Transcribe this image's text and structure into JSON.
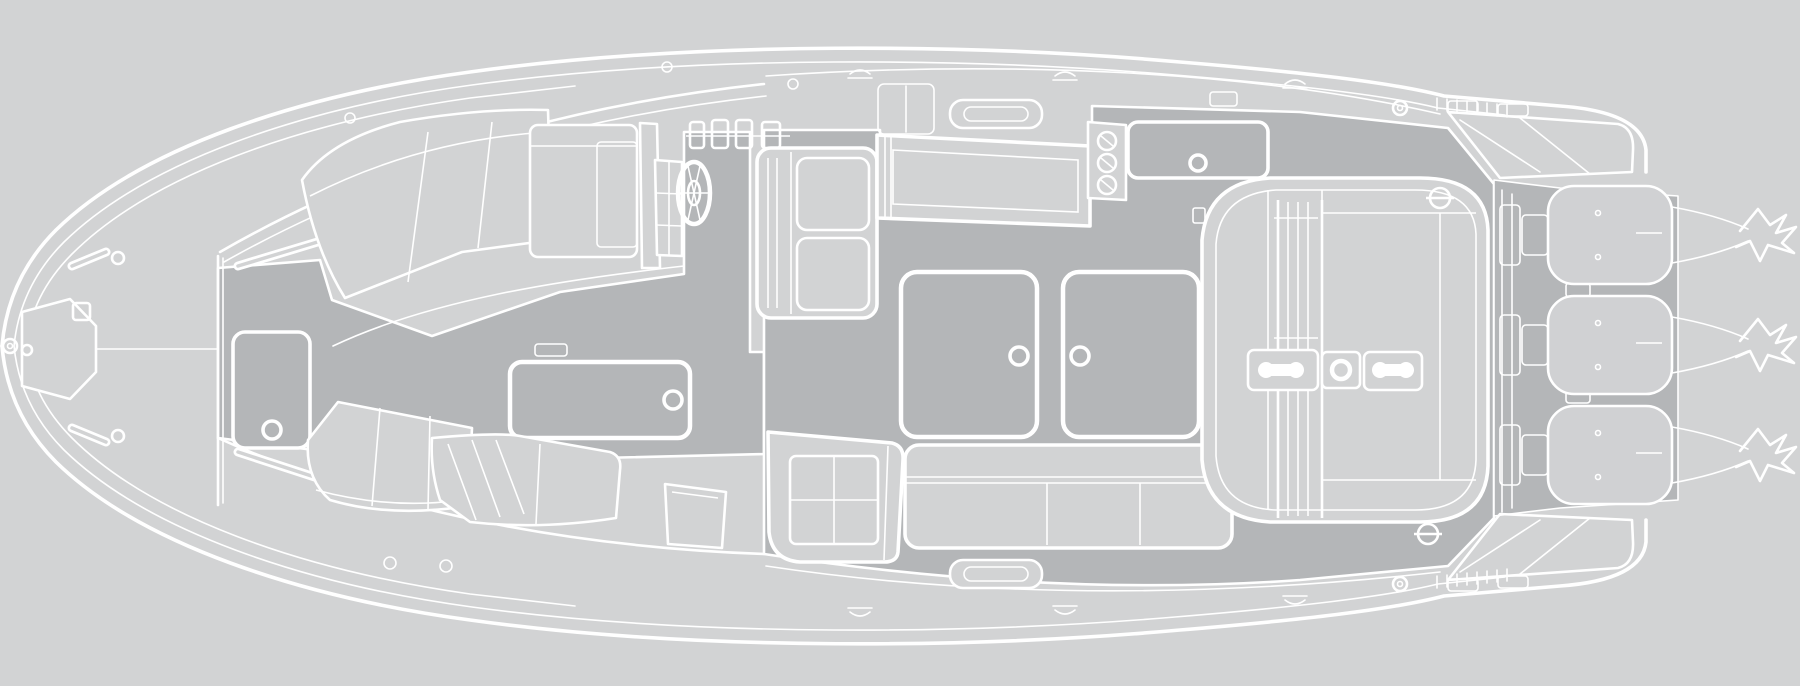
{
  "diagram": {
    "type": "boat-deck-plan",
    "view": "top-down floor plan, bow at left, stern with outboard engines at right",
    "style": "white CAD linework on gray background",
    "engine_count": 3,
    "text_labels": []
  },
  "colors": {
    "background": "#d2d3d4",
    "deck_light": "#d2d3d4",
    "floor_dark": "#b4b6b8",
    "engine_cowl": "#d0d1d3",
    "line": "#ffffff"
  },
  "components": [
    "hull-outline",
    "bow-eye",
    "anchor-locker",
    "foredeck-walkway",
    "foredeck-hatch",
    "bow-lounge-port",
    "bow-lounge-starboard",
    "grab-rails",
    "windshield",
    "port-cabinet",
    "helm-console",
    "steering-wheel",
    "helm-seat",
    "walkthrough-corridor",
    "galley-wetbar",
    "grill-burners",
    "gunwale-storage-hatch",
    "cockpit-floor",
    "cockpit-hatch-forward",
    "cockpit-hatch-aft",
    "companion-seat",
    "side-bench-seat",
    "aft-bench",
    "aft-sunpad",
    "walkthrough-rails",
    "stern-cleats",
    "corner-latches",
    "transom",
    "swim-platform-port",
    "swim-platform-starboard",
    "outboard-engine-1",
    "outboard-engine-2",
    "outboard-engine-3",
    "propellers"
  ]
}
